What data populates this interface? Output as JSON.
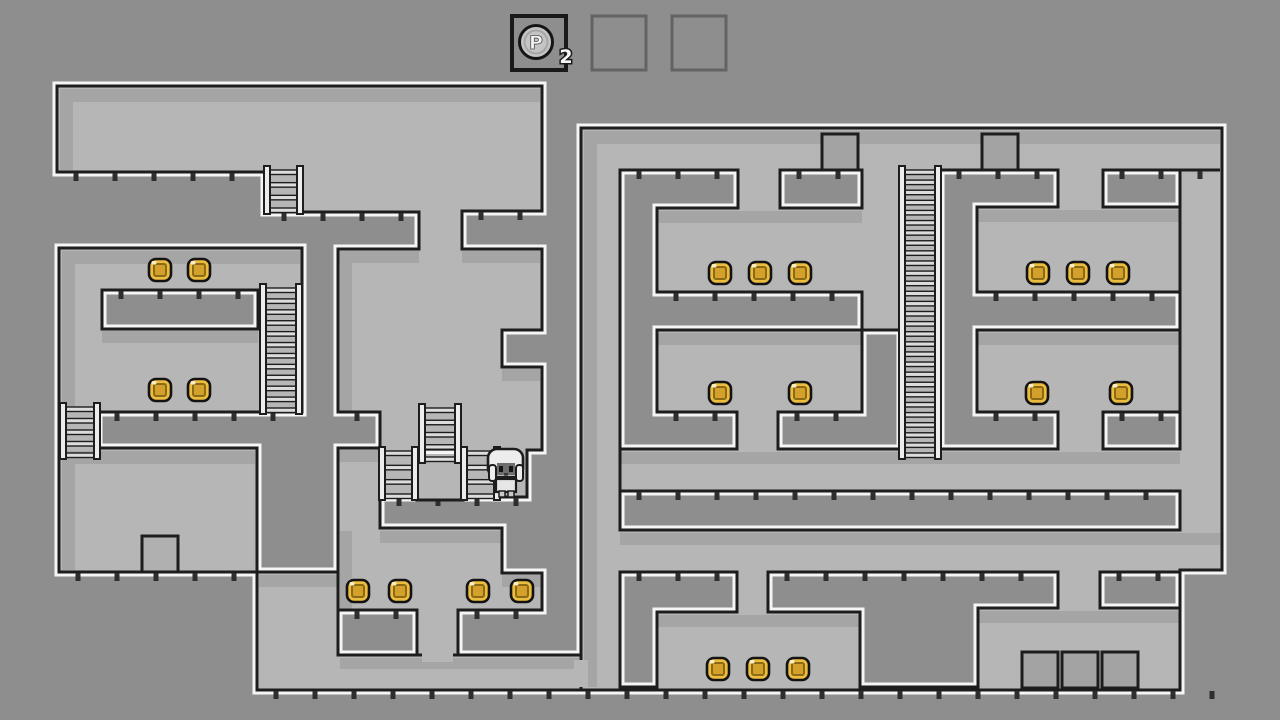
{
  "hud": {
    "p_coin_label": "P",
    "p_coin_count": "2",
    "slots": [
      {
        "state": "filled",
        "border": "#1a1a1a"
      },
      {
        "state": "empty",
        "border": "#636363"
      },
      {
        "state": "empty",
        "border": "#636363"
      }
    ],
    "slot_geometry": {
      "y": 16,
      "size": 54,
      "xs": [
        512,
        592,
        672
      ]
    }
  },
  "palette": {
    "background": "#8e8e8e",
    "room": "#b6b6b6",
    "shadow": "#a5a5a5",
    "outline": "#1d1d1d",
    "edge_highlight": "#f5f5f5",
    "tick": "#2e2e2e",
    "coin_gold": "#ecbc3f",
    "coin_inner": "#d3a02c",
    "coin_line": "#8a6a14",
    "ladder_rail": "#ececec",
    "ladder_rung": "#dcdcdc",
    "crate": "#a3a3a3",
    "crate_light": "#b0b0b0",
    "pcoin": "#c4c4c4"
  },
  "level": {
    "regions": [
      {
        "name": "upper-left-halls",
        "points": [
          [
            57,
            86
          ],
          [
            542,
            86
          ],
          [
            542,
            211
          ],
          [
            462,
            211
          ],
          [
            462,
            249
          ],
          [
            542,
            249
          ],
          [
            542,
            330
          ],
          [
            502,
            330
          ],
          [
            502,
            367
          ],
          [
            542,
            367
          ],
          [
            542,
            450
          ],
          [
            527,
            450
          ],
          [
            527,
            497
          ],
          [
            380,
            497
          ],
          [
            380,
            528
          ],
          [
            502,
            528
          ],
          [
            502,
            573
          ],
          [
            542,
            573
          ],
          [
            542,
            610
          ],
          [
            458,
            610
          ],
          [
            458,
            655
          ],
          [
            417,
            655
          ],
          [
            417,
            610
          ],
          [
            338,
            610
          ],
          [
            338,
            448
          ],
          [
            380,
            448
          ],
          [
            380,
            412
          ],
          [
            338,
            412
          ],
          [
            338,
            249
          ],
          [
            419,
            249
          ],
          [
            419,
            212
          ],
          [
            265,
            212
          ],
          [
            265,
            172
          ],
          [
            57,
            172
          ]
        ]
      },
      {
        "name": "left-coin-rooms",
        "points": [
          [
            59,
            248
          ],
          [
            302,
            248
          ],
          [
            302,
            412
          ],
          [
            98,
            412
          ],
          [
            98,
            448
          ],
          [
            257,
            448
          ],
          [
            257,
            572
          ],
          [
            59,
            572
          ]
        ]
      },
      {
        "name": "lower-left-corridor",
        "points": [
          [
            257,
            572
          ],
          [
            338,
            572
          ],
          [
            338,
            655
          ],
          [
            581,
            655
          ],
          [
            581,
            690
          ],
          [
            257,
            690
          ]
        ]
      },
      {
        "name": "right-wing",
        "points": [
          [
            581,
            128
          ],
          [
            1222,
            128
          ],
          [
            1222,
            570
          ],
          [
            1180,
            570
          ],
          [
            1180,
            690
          ],
          [
            581,
            690
          ]
        ]
      }
    ],
    "holes": [
      {
        "name": "left-room-block",
        "points": [
          [
            102,
            290
          ],
          [
            258,
            290
          ],
          [
            258,
            329
          ],
          [
            102,
            329
          ]
        ]
      },
      {
        "name": "right-block-top-left",
        "points": [
          [
            620,
            170
          ],
          [
            738,
            170
          ],
          [
            738,
            208
          ],
          [
            657,
            208
          ],
          [
            657,
            292
          ],
          [
            862,
            292
          ],
          [
            862,
            330
          ],
          [
            657,
            330
          ],
          [
            657,
            412
          ],
          [
            737,
            412
          ],
          [
            737,
            449
          ],
          [
            620,
            449
          ]
        ]
      },
      {
        "name": "right-block-top-mid",
        "points": [
          [
            780,
            170
          ],
          [
            862,
            170
          ],
          [
            862,
            208
          ],
          [
            780,
            208
          ]
        ]
      },
      {
        "name": "right-block-top-right",
        "points": [
          [
            940,
            170
          ],
          [
            1058,
            170
          ],
          [
            1058,
            207
          ],
          [
            977,
            207
          ],
          [
            977,
            292
          ],
          [
            1180,
            292
          ],
          [
            1180,
            330
          ],
          [
            977,
            330
          ],
          [
            977,
            412
          ],
          [
            1058,
            412
          ],
          [
            1058,
            449
          ],
          [
            940,
            449
          ]
        ]
      },
      {
        "name": "right-block-notch",
        "points": [
          [
            1103,
            170
          ],
          [
            1180,
            170
          ],
          [
            1180,
            207
          ],
          [
            1103,
            207
          ]
        ]
      },
      {
        "name": "right-block-mid-left",
        "points": [
          [
            778,
            412
          ],
          [
            862,
            412
          ],
          [
            862,
            330
          ],
          [
            901,
            330
          ],
          [
            901,
            449
          ],
          [
            778,
            449
          ]
        ]
      },
      {
        "name": "right-block-mid-right",
        "points": [
          [
            1103,
            412
          ],
          [
            1180,
            412
          ],
          [
            1180,
            449
          ],
          [
            1103,
            449
          ]
        ]
      },
      {
        "name": "right-long-bar",
        "points": [
          [
            620,
            491
          ],
          [
            1180,
            491
          ],
          [
            1180,
            530
          ],
          [
            620,
            530
          ]
        ]
      },
      {
        "name": "right-bottom-left",
        "points": [
          [
            620,
            572
          ],
          [
            737,
            572
          ],
          [
            737,
            612
          ],
          [
            657,
            612
          ],
          [
            657,
            687
          ],
          [
            620,
            687
          ]
        ]
      },
      {
        "name": "right-bottom-mid",
        "points": [
          [
            768,
            572
          ],
          [
            1058,
            572
          ],
          [
            1058,
            608
          ],
          [
            978,
            608
          ],
          [
            978,
            687
          ],
          [
            860,
            687
          ],
          [
            860,
            612
          ],
          [
            768,
            612
          ]
        ]
      },
      {
        "name": "right-bottom-right",
        "points": [
          [
            1100,
            572
          ],
          [
            1180,
            572
          ],
          [
            1180,
            608
          ],
          [
            1100,
            608
          ]
        ]
      }
    ],
    "shadows": [
      [
        60,
        89,
        480,
        13
      ],
      [
        60,
        89,
        13,
        81
      ],
      [
        338,
        251,
        81,
        12
      ],
      [
        462,
        251,
        78,
        12
      ],
      [
        502,
        369,
        38,
        12
      ],
      [
        380,
        531,
        122,
        12
      ],
      [
        502,
        575,
        38,
        12
      ],
      [
        338,
        450,
        42,
        12
      ],
      [
        62,
        251,
        238,
        13
      ],
      [
        62,
        251,
        13,
        159
      ],
      [
        102,
        331,
        156,
        12
      ],
      [
        62,
        451,
        193,
        13
      ],
      [
        62,
        451,
        13,
        119
      ],
      [
        259,
        575,
        79,
        12
      ],
      [
        340,
        658,
        239,
        11
      ],
      [
        584,
        131,
        636,
        13
      ],
      [
        584,
        131,
        13,
        556
      ],
      [
        657,
        211,
        205,
        12
      ],
      [
        977,
        210,
        203,
        12
      ],
      [
        657,
        333,
        205,
        12
      ],
      [
        977,
        333,
        203,
        12
      ],
      [
        620,
        452,
        560,
        12
      ],
      [
        620,
        533,
        600,
        12
      ],
      [
        657,
        615,
        203,
        12
      ],
      [
        978,
        611,
        202,
        12
      ],
      [
        340,
        251,
        12,
        161
      ],
      [
        340,
        531,
        12,
        79
      ]
    ],
    "patches": [
      [
        422,
        648,
        31,
        14
      ],
      [
        574,
        660,
        14,
        27
      ]
    ],
    "walls": [
      {
        "name": "thin-wall-a",
        "x1": 1180,
        "y1": 207,
        "x2": 1180,
        "y2": 292
      },
      {
        "name": "thin-wall-b",
        "x1": 1180,
        "y1": 330,
        "x2": 1180,
        "y2": 412
      },
      {
        "name": "thin-wall-c",
        "x1": 620,
        "y1": 449,
        "x2": 620,
        "y2": 491
      },
      {
        "name": "ledge-line",
        "x1": 1180,
        "y1": 170,
        "x2": 1220,
        "y2": 170
      }
    ],
    "floors": [
      {
        "y": 172,
        "x1": 57,
        "x2": 265
      },
      {
        "y": 212,
        "x1": 265,
        "x2": 419
      },
      {
        "y": 211,
        "x1": 462,
        "x2": 542
      },
      {
        "y": 290,
        "x1": 102,
        "x2": 258
      },
      {
        "y": 412,
        "x1": 98,
        "x2": 302
      },
      {
        "y": 412,
        "x1": 338,
        "x2": 380
      },
      {
        "y": 572,
        "x1": 59,
        "x2": 257
      },
      {
        "y": 610,
        "x1": 338,
        "x2": 417
      },
      {
        "y": 610,
        "x1": 458,
        "x2": 542
      },
      {
        "y": 497,
        "x1": 380,
        "x2": 527
      },
      {
        "y": 690,
        "x1": 257,
        "x2": 1222
      },
      {
        "y": 170,
        "x1": 620,
        "x2": 738
      },
      {
        "y": 170,
        "x1": 780,
        "x2": 862
      },
      {
        "y": 170,
        "x1": 940,
        "x2": 1058
      },
      {
        "y": 170,
        "x1": 1103,
        "x2": 1218
      },
      {
        "y": 292,
        "x1": 657,
        "x2": 862
      },
      {
        "y": 292,
        "x1": 977,
        "x2": 1180
      },
      {
        "y": 412,
        "x1": 657,
        "x2": 737
      },
      {
        "y": 412,
        "x1": 778,
        "x2": 862
      },
      {
        "y": 412,
        "x1": 977,
        "x2": 1058
      },
      {
        "y": 412,
        "x1": 1103,
        "x2": 1180
      },
      {
        "y": 491,
        "x1": 620,
        "x2": 1180
      },
      {
        "y": 572,
        "x1": 620,
        "x2": 737
      },
      {
        "y": 572,
        "x1": 768,
        "x2": 1058
      },
      {
        "y": 572,
        "x1": 1100,
        "x2": 1180
      }
    ],
    "platform_block": {
      "x": 417,
      "y": 449,
      "w": 46,
      "h": 51
    },
    "ladders": [
      {
        "x": 264,
        "y": 166,
        "w": 39,
        "h": 48
      },
      {
        "x": 260,
        "y": 284,
        "w": 42,
        "h": 130
      },
      {
        "x": 60,
        "y": 403,
        "w": 40,
        "h": 56
      },
      {
        "x": 419,
        "y": 404,
        "w": 42,
        "h": 59
      },
      {
        "x": 379,
        "y": 447,
        "w": 39,
        "h": 53
      },
      {
        "x": 461,
        "y": 447,
        "w": 39,
        "h": 53
      },
      {
        "x": 899,
        "y": 166,
        "w": 42,
        "h": 293
      }
    ],
    "coins": [
      [
        160,
        270
      ],
      [
        199,
        270
      ],
      [
        160,
        390
      ],
      [
        199,
        390
      ],
      [
        358,
        591
      ],
      [
        400,
        591
      ],
      [
        478,
        591
      ],
      [
        522,
        591
      ],
      [
        720,
        273
      ],
      [
        760,
        273
      ],
      [
        800,
        273
      ],
      [
        1038,
        273
      ],
      [
        1078,
        273
      ],
      [
        1118,
        273
      ],
      [
        720,
        393
      ],
      [
        800,
        393
      ],
      [
        1037,
        393
      ],
      [
        1121,
        393
      ],
      [
        718,
        669
      ],
      [
        758,
        669
      ],
      [
        798,
        669
      ]
    ],
    "crates": [
      {
        "x": 822,
        "y": 134,
        "s": 36,
        "tone": "crate"
      },
      {
        "x": 982,
        "y": 134,
        "s": 36,
        "tone": "crate"
      },
      {
        "x": 142,
        "y": 536,
        "s": 36,
        "tone": "crate_light"
      },
      {
        "x": 1022,
        "y": 652,
        "s": 36,
        "tone": "crate"
      },
      {
        "x": 1062,
        "y": 652,
        "s": 36,
        "tone": "crate"
      },
      {
        "x": 1102,
        "y": 652,
        "s": 36,
        "tone": "crate"
      }
    ],
    "character": {
      "x": 488,
      "y": 449
    }
  }
}
